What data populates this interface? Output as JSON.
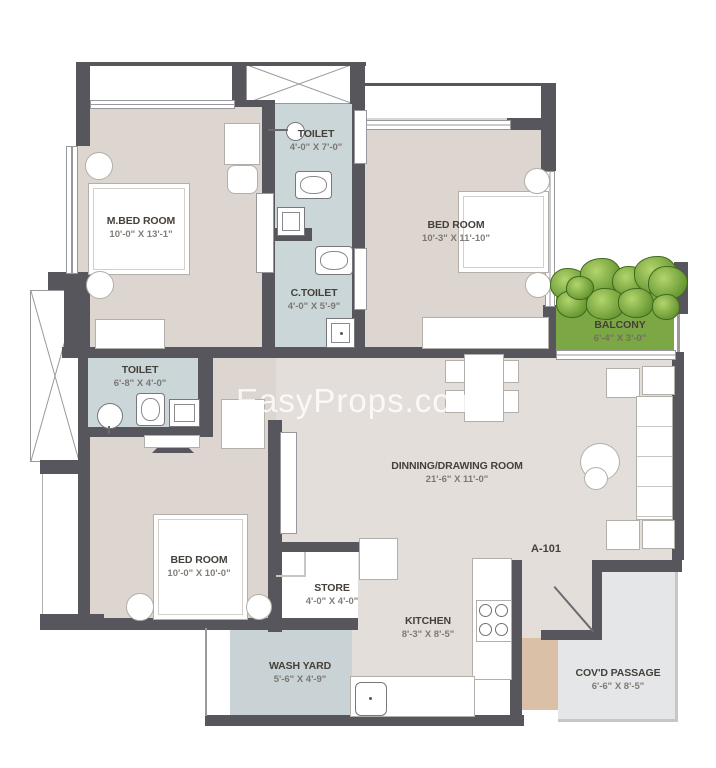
{
  "watermark": "EasyProps.com",
  "unit": {
    "label": "A-101"
  },
  "rooms": [
    {
      "name": "M.BED ROOM",
      "dims": "10'-0\" X 13'-1\""
    },
    {
      "name": "TOILET",
      "dims": "4'-0\" X 7'-0\""
    },
    {
      "name": "BED ROOM",
      "dims": "10'-3\" X 11'-10\""
    },
    {
      "name": "C.TOILET",
      "dims": "4'-0\" X 5'-9\""
    },
    {
      "name": "BALCONY",
      "dims": "6'-4\" X 3'-0\""
    },
    {
      "name": "TOILET",
      "dims": "6'-8\" X 4'-0\""
    },
    {
      "name": "DINNING/DRAWING ROOM",
      "dims": "21'-6\" X 11'-0\""
    },
    {
      "name": "BED ROOM",
      "dims": "10'-0\" X 10'-0\""
    },
    {
      "name": "STORE",
      "dims": "4'-0\" X 4'-0\""
    },
    {
      "name": "KITCHEN",
      "dims": "8'-3\" X 8'-5\""
    },
    {
      "name": "WASH YARD",
      "dims": "5'-6\" X 4'-9\""
    },
    {
      "name": "COV'D PASSAGE",
      "dims": "6'-6\" X 8'-5\""
    }
  ],
  "colors": {
    "wall": "#56565c",
    "bedroom_floor": "#ddd5d0",
    "living_floor": "#e3ded9",
    "toilet_floor": "#cbd6d8",
    "washyard_floor": "#c9d3d5",
    "balcony_green": "#7ca745",
    "passage_floor": "#e4e6e8",
    "lift_tan": "#d9c0a6",
    "label_text": "#45403a",
    "dim_text": "#6e6761",
    "watermark": "#ffffff"
  }
}
